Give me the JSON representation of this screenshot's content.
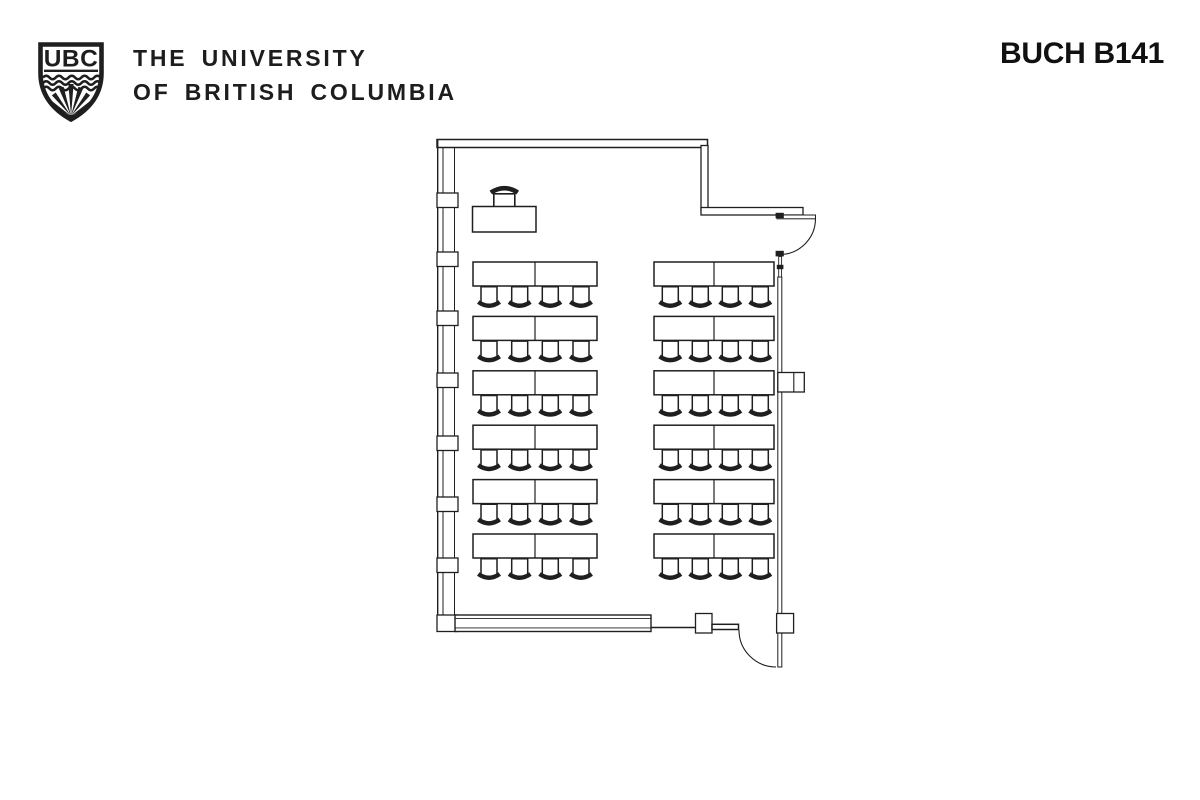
{
  "header": {
    "logo_acronym": "UBC",
    "university_line1": "THE UNIVERSITY",
    "university_line2": "OF BRITISH COLUMBIA",
    "room_title": "BUCH B141"
  },
  "floor_plan": {
    "kind": "classroom-seating-plan",
    "desk_rows": 6,
    "desk_columns": 2,
    "seats_per_desk": 4,
    "total_seats": 48,
    "features": [
      "window-wall-left",
      "entry-door-top-right",
      "entry-door-bottom-right",
      "instructor-desk",
      "instructor-chair",
      "wall-pilaster-right"
    ],
    "colors": {
      "line": "#1f1f1f",
      "background": "#ffffff",
      "ink": "#1d1d1d"
    }
  }
}
